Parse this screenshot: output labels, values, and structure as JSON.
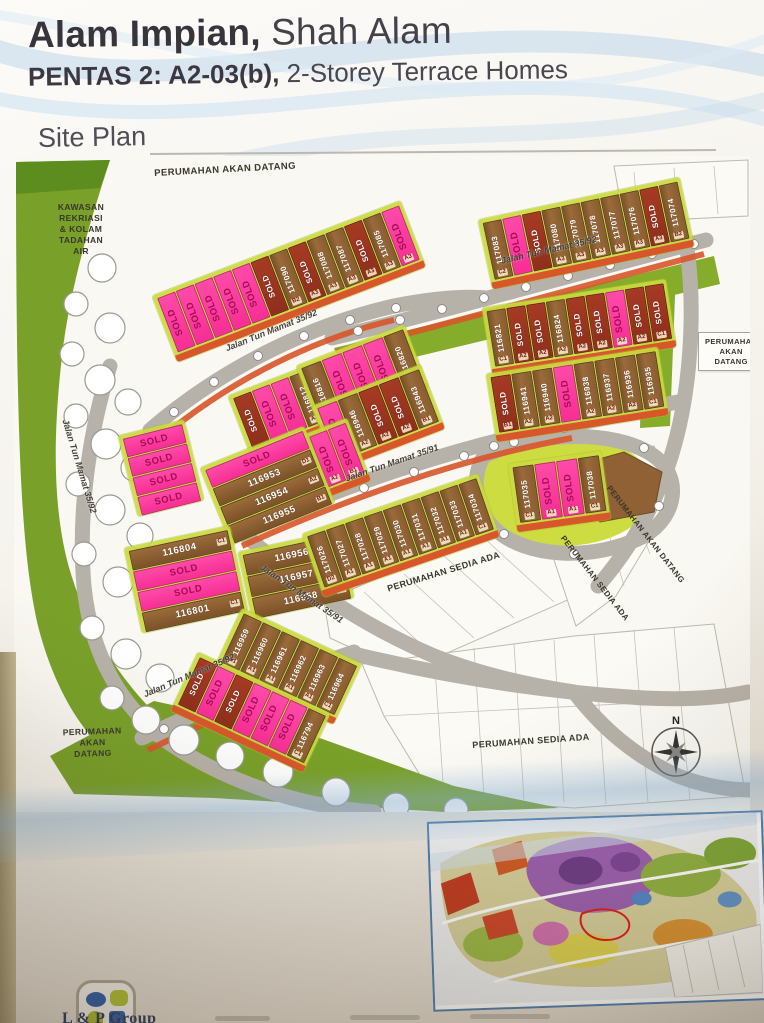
{
  "header": {
    "title_bold": "Alam Impian,",
    "title_light": " Shah Alam",
    "subtitle_bold": "PENTAS 2: A2-03(b),",
    "subtitle_light": " 2-Storey Terrace Homes",
    "section_label": "Site Plan"
  },
  "site_plan": {
    "sold_label": "SOLD",
    "compass": "N",
    "colors": {
      "sold_sticker_pink": "#f72e95",
      "sold_strip_dark_red": "#8e2f1c",
      "lot_brown": "#8a5c30",
      "lot_backing_lime": "#c9da3e",
      "landscape_green": "#79a129",
      "road_gray": "#b7b2a9",
      "back_lane_orange": "#d8572a"
    },
    "roads": [
      {
        "label": "Jalan Tun Mamat 35/92"
      },
      {
        "label": "Jalan Tun Mamat 35/92"
      },
      {
        "label": "Jalan Tun Mamat 35/92"
      },
      {
        "label": "Jalan Tun Mamat 35/92"
      },
      {
        "label": "Jalan Tun Mamat 35/91"
      },
      {
        "label": "Jalan Tun Mamat 35/91"
      }
    ],
    "areas": [
      {
        "lines": [
          "PERUMAHAN AKAN DATANG"
        ]
      },
      {
        "lines": [
          "KAWASAN",
          "REKRIASI",
          "& KOLAM",
          "TADAHAN",
          "AIR"
        ]
      },
      {
        "lines": [
          "PERUMAHAN",
          "AKAN",
          "DATANG"
        ]
      },
      {
        "lines": [
          "PERUMAHAN SEDIA ADA"
        ]
      },
      {
        "lines": [
          "PERUMAHAN AKAN DATANG"
        ]
      },
      {
        "lines": [
          "PERUMAHAN SEDIA ADA"
        ]
      },
      {
        "lines": [
          "PERUMAHAN",
          "AKAN",
          "DATANG"
        ]
      },
      {
        "lines": [
          "PERUMAHAN SEDIA ADA"
        ]
      }
    ],
    "clusters": [
      {
        "id": "c1",
        "lots": [
          {
            "sold": "pink"
          },
          {
            "sold": "pink"
          },
          {
            "sold": "pink"
          },
          {
            "sold": "pink"
          },
          {
            "sold": "pink"
          },
          {
            "sold": "dark"
          },
          {
            "n": "117090",
            "u": "B2"
          },
          {
            "sold": "dark",
            "u": "A3"
          },
          {
            "n": "117088",
            "u": "A3"
          },
          {
            "n": "117087",
            "u": "A3"
          },
          {
            "sold": "dark",
            "u": "A3"
          },
          {
            "n": "117085",
            "u": "A3"
          },
          {
            "sold": "pink",
            "u": "A3"
          }
        ]
      },
      {
        "id": "c2",
        "lots": [
          {
            "n": "117083",
            "u": "C2"
          },
          {
            "sold": "pink"
          },
          {
            "sold": "dark"
          },
          {
            "n": "117080",
            "u": "A3"
          },
          {
            "n": "117079",
            "u": "A3"
          },
          {
            "n": "117078",
            "u": "A3"
          },
          {
            "n": "117077",
            "u": "A3"
          },
          {
            "n": "117076",
            "u": "A3"
          },
          {
            "sold": "dark",
            "u": "A3"
          },
          {
            "n": "117074",
            "u": "B2"
          }
        ]
      },
      {
        "id": "c3",
        "lots": [
          {
            "sold": "dark"
          },
          {
            "sold": "pink"
          },
          {
            "sold": "pink"
          },
          {
            "n": "116812",
            "u": "A2"
          },
          {
            "n": "116813",
            "u": "A2"
          },
          {
            "n": "116814",
            "u": "A2"
          },
          {
            "sold": "dark",
            "u": "B1"
          }
        ]
      },
      {
        "id": "c4",
        "lots": [
          {
            "n": "116821",
            "u": "C1"
          },
          {
            "sold": "dark",
            "u": "A2"
          },
          {
            "sold": "dark",
            "u": "A2"
          },
          {
            "n": "116824",
            "u": "A2"
          },
          {
            "sold": "dark",
            "u": "A2"
          },
          {
            "sold": "dark",
            "u": "A2"
          },
          {
            "sold": "pink",
            "u": "A2"
          },
          {
            "sold": "dark",
            "u": "A2"
          },
          {
            "sold": "dark",
            "u": "C1"
          }
        ]
      },
      {
        "id": "c5",
        "lots": [
          {
            "sold": "dark",
            "u": "B1"
          },
          {
            "n": "116941",
            "u": "A2"
          },
          {
            "n": "116940",
            "u": "A2"
          },
          {
            "sold": "pink"
          },
          {
            "n": "116938",
            "u": "A2"
          },
          {
            "n": "116937",
            "u": "A2"
          },
          {
            "n": "116936",
            "u": "A2"
          },
          {
            "n": "116935",
            "u": "C1"
          }
        ]
      },
      {
        "id": "c6",
        "lots": [
          {
            "n": "116816",
            "u": "B1"
          },
          {
            "sold": "pink",
            "u": "A2"
          },
          {
            "sold": "pink",
            "u": "A2"
          },
          {
            "sold": "pink",
            "u": "A2"
          },
          {
            "n": "116820",
            "u": "C1"
          }
        ]
      },
      {
        "id": "c7",
        "lots": [
          {
            "sold": "pink",
            "u": "B1"
          },
          {
            "n": "116946",
            "u": "A2"
          },
          {
            "sold": "dark",
            "u": "A2"
          },
          {
            "sold": "dark",
            "u": "A2"
          },
          {
            "n": "116943",
            "u": "B1"
          }
        ]
      },
      {
        "id": "c8",
        "lots": [
          {
            "sold": "pink",
            "u": "B1"
          },
          {
            "n": "116951",
            "u": "A2"
          },
          {
            "sold": "pink",
            "u": "A2"
          },
          {
            "sold": "pink",
            "u": "A2"
          },
          {
            "sold": "pink",
            "u": "B1"
          }
        ]
      },
      {
        "id": "c9",
        "lots": [
          {
            "sold": "pink"
          },
          {
            "sold": "pink"
          },
          {
            "sold": "pink"
          },
          {
            "sold": "pink"
          }
        ]
      },
      {
        "id": "c10",
        "lots": [
          {
            "sold": "pink"
          },
          {
            "n": "116953",
            "u": "D1"
          },
          {
            "n": "116954",
            "u": "A2"
          },
          {
            "n": "116955",
            "u": "B1"
          }
        ]
      },
      {
        "id": "c11",
        "lots": [
          {
            "n": "116804",
            "u": "C1"
          },
          {
            "sold": "pink"
          },
          {
            "sold": "pink"
          },
          {
            "n": "116801",
            "u": "C1"
          }
        ]
      },
      {
        "id": "c12",
        "lots": [
          {
            "n": "116956",
            "u": "B1"
          },
          {
            "n": "116957",
            "u": "A2"
          },
          {
            "n": "116958",
            "u": "D1"
          }
        ]
      },
      {
        "id": "c13",
        "lots": [
          {
            "n": "117026",
            "u": "D2"
          },
          {
            "n": "117027",
            "u": "A1"
          },
          {
            "n": "117028",
            "u": "A1"
          },
          {
            "n": "117029",
            "u": "A1"
          },
          {
            "n": "117030",
            "u": "A1"
          },
          {
            "n": "117031",
            "u": "A1"
          },
          {
            "n": "117032",
            "u": "A1"
          },
          {
            "n": "117033",
            "u": "A1"
          },
          {
            "n": "117034",
            "u": "C1"
          }
        ]
      },
      {
        "id": "c14",
        "lots": [
          {
            "n": "117035",
            "u": "C1"
          },
          {
            "sold": "pink",
            "u": "A1"
          },
          {
            "sold": "pink",
            "u": "A1"
          },
          {
            "n": "117038",
            "u": "C1"
          }
        ]
      },
      {
        "id": "c15",
        "lots": [
          {
            "n": "116959",
            "u": "B1"
          },
          {
            "n": "116960",
            "u": "A1"
          },
          {
            "n": "116961",
            "u": "A1"
          },
          {
            "n": "116962",
            "u": "A1"
          },
          {
            "n": "116963",
            "u": "A1"
          },
          {
            "n": "116964",
            "u": "C1"
          }
        ]
      },
      {
        "id": "c16",
        "lots": [
          {
            "sold": "dark"
          },
          {
            "sold": "pink"
          },
          {
            "sold": "dark"
          },
          {
            "sold": "pink"
          },
          {
            "sold": "pink"
          },
          {
            "sold": "pink"
          },
          {
            "n": "116794",
            "u": "C1"
          }
        ]
      }
    ]
  },
  "footer": {
    "logo_text": "L & P Group"
  }
}
